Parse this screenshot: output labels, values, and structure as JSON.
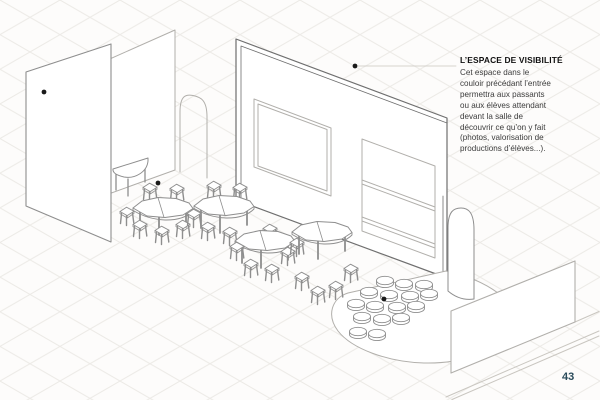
{
  "page": {
    "number": "43"
  },
  "annotation": {
    "title": "L’ESPACE DE VISIBILITÉ",
    "lines": [
      "Cet espace dans le",
      "couloir précédant l’entrée",
      "permettra aux passants",
      "ou aux élèves attendant",
      "devant la salle de",
      "découvrir ce qu’on y fait",
      "(photos, valorisation de",
      "productions d’élèves...)."
    ]
  },
  "colors": {
    "page_number": "#2a4b5b",
    "marker_dot": "#1a1a1a",
    "annotation_title": "#111111",
    "annotation_body": "#3c3c3c",
    "paper": "#fdfcfb"
  }
}
